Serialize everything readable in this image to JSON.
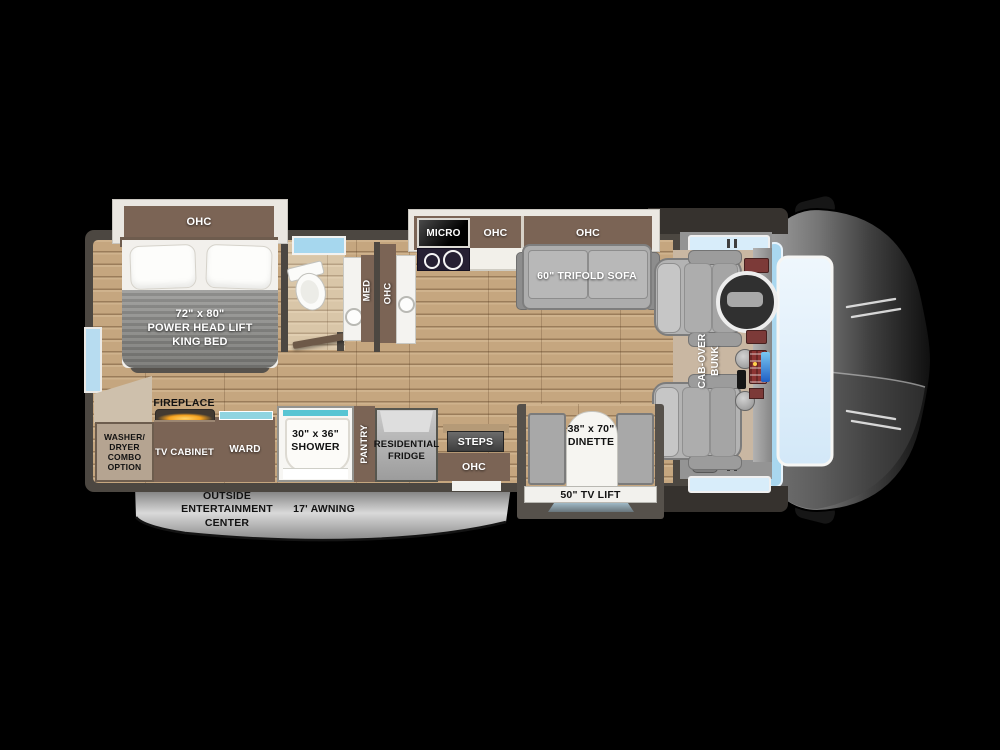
{
  "title": "Class C motorhome floor plan",
  "colors": {
    "background": "#000000",
    "wall": "#4c4741",
    "wood_floor": "#c5a67f",
    "bath_floor": "#d9c6a8",
    "cabinet_brown": "#7b6455",
    "slide_trim": "#ebe8e2",
    "blanket_gray": "#8d8d8b",
    "sofa_gray": "#adadad",
    "teal_accent": "#58c5d3",
    "fire_orange": "#f6a21f",
    "windshield_blue": "#d8edfa",
    "awning_gray": "#c6c6c6",
    "micro_black": "#0a0a0a"
  },
  "floorplan": {
    "bedroom": {
      "ohc_slideout_label": "OHC",
      "bed_label": "72\" x 80\"\nPOWER  HEAD LIFT\nKING BED",
      "fireplace_label": "FIREPLACE",
      "washer_dryer_label": "WASHER/\nDRYER\nCOMBO\nOPTION",
      "tv_cabinet_label": "TV CABINET",
      "ward_label": "WARD"
    },
    "bathroom": {
      "med_label": "MED",
      "ohc_label": "OHC",
      "shower_label": "30\" x 36\"\nSHOWER"
    },
    "kitchen": {
      "micro_label": "MICRO",
      "ohc_label": "OHC",
      "pantry_label": "PANTRY",
      "fridge_label": "RESIDENTIAL\nFRIDGE",
      "steps_label": "STEPS",
      "entry_ohc_label": "OHC"
    },
    "living": {
      "sofa_ohc_label": "OHC",
      "sofa_label": "60\" TRIFOLD SOFA",
      "dinette_label": "38\" x 70\"\nDINETTE",
      "tv_lift_label": "50\" TV LIFT"
    },
    "cab": {
      "bunk_label": "CAB-OVER\nBUNK"
    },
    "exterior": {
      "entertainment_label": "OUTSIDE\nENTERTAINMENT\nCENTER",
      "awning_label": "17' AWNING"
    }
  }
}
